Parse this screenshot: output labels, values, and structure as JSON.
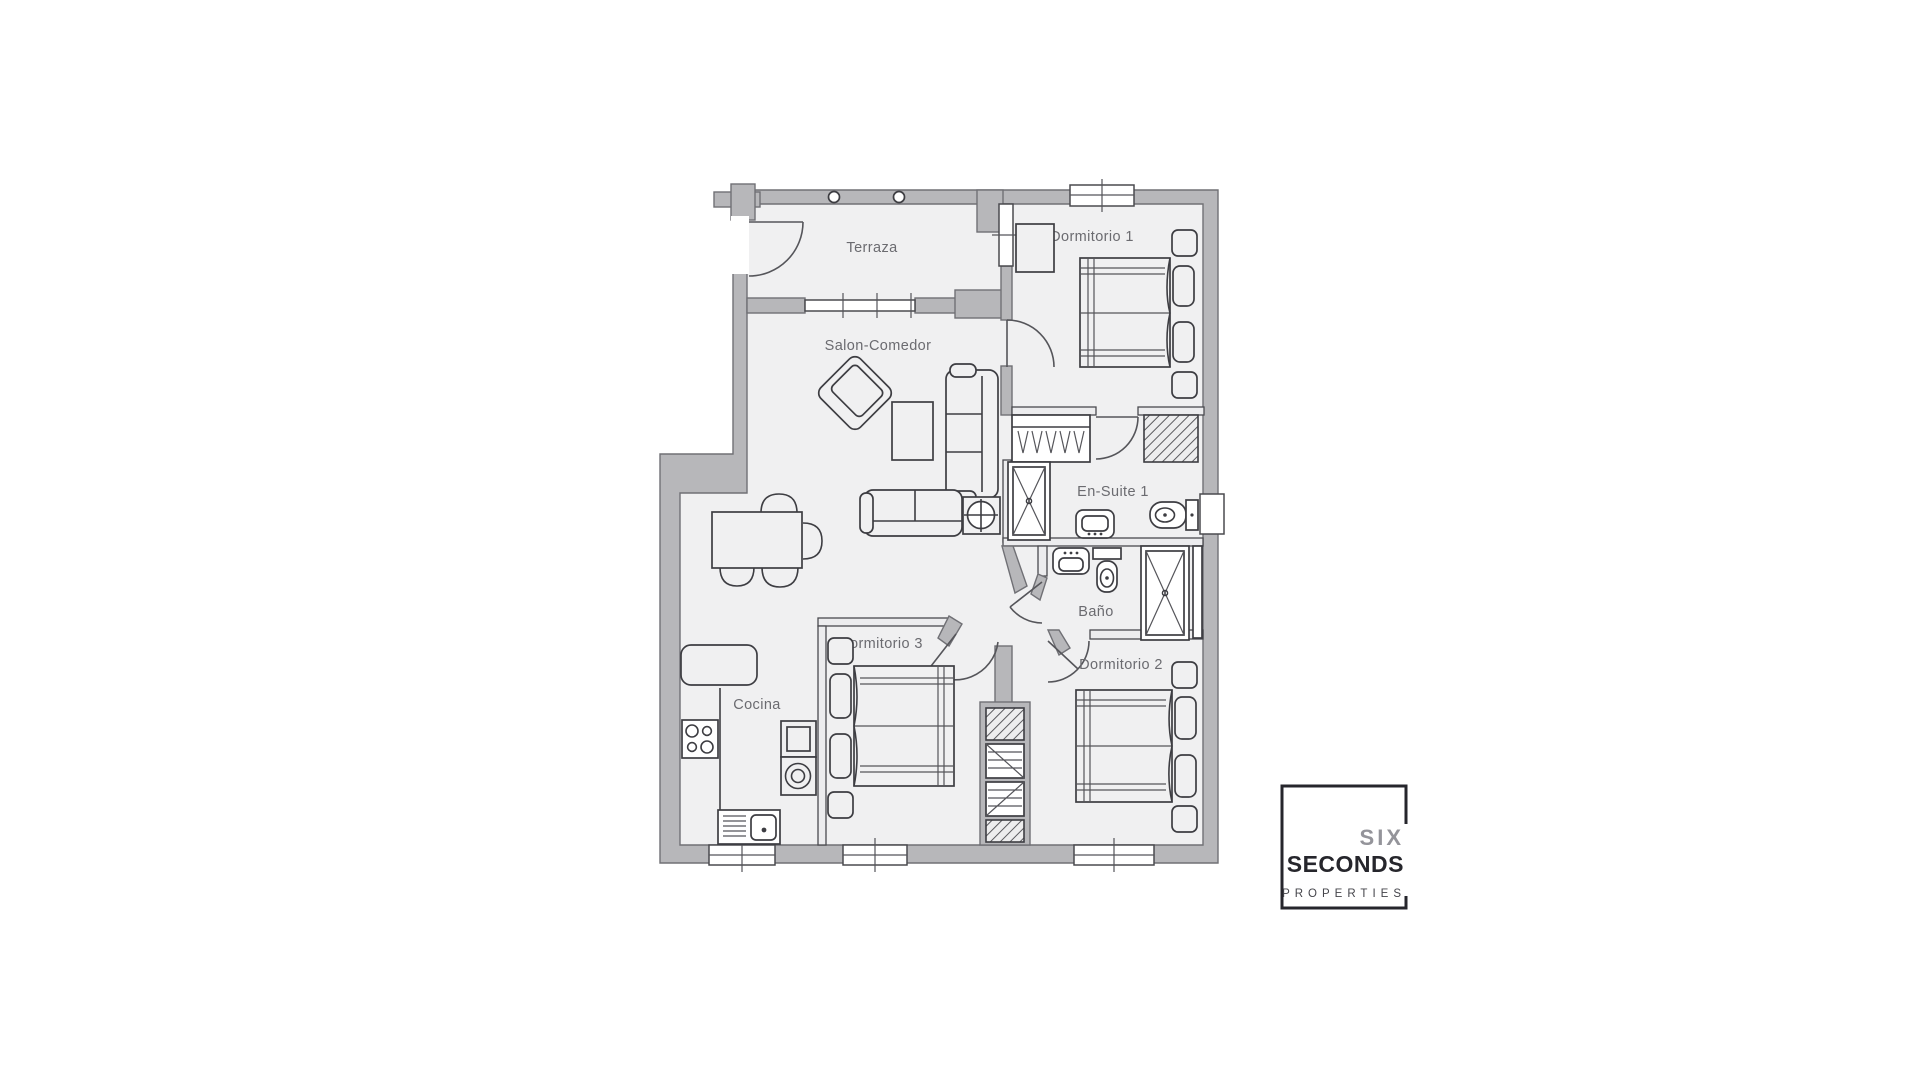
{
  "floorplan": {
    "rooms": [
      {
        "id": "terraza",
        "label": "Terraza"
      },
      {
        "id": "dormitorio-1",
        "label": "Dormitorio 1"
      },
      {
        "id": "salon-comedor",
        "label": "Salon-Comedor"
      },
      {
        "id": "en-suite-1",
        "label": "En-Suite 1"
      },
      {
        "id": "bano",
        "label": "Baño"
      },
      {
        "id": "dormitorio-3",
        "label": "Dormitorio 3"
      },
      {
        "id": "dormitorio-2",
        "label": "Dormitorio 2"
      },
      {
        "id": "cocina",
        "label": "Cocina"
      }
    ],
    "colors": {
      "wall": "#b7b7ba",
      "wall_outline": "#707075",
      "floor": "#f0f0f1",
      "furniture_line": "#3d3d42",
      "label_text": "#6b6b70"
    }
  },
  "logo": {
    "line1": "SIX",
    "line2": "SECONDS",
    "line3": "PROPERTIES",
    "color_dark": "#26262c",
    "color_gray": "#94949a"
  }
}
